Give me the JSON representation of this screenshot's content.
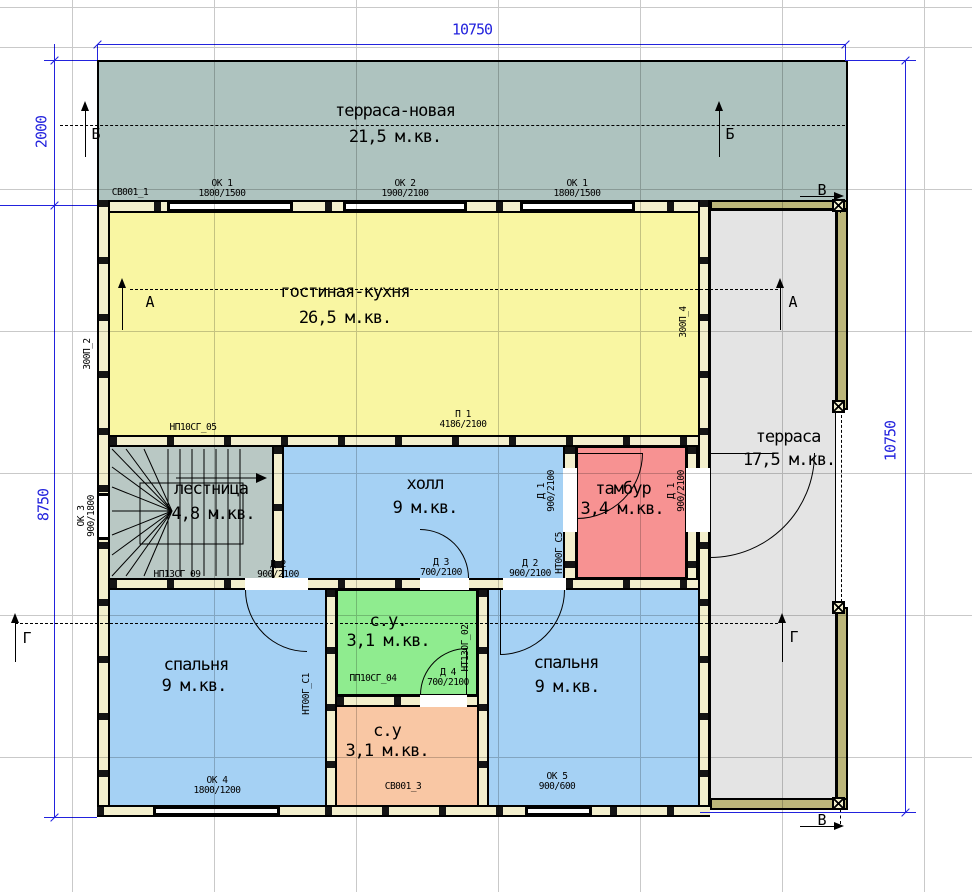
{
  "rooms": {
    "terrace_new": {
      "name": "терраса-новая",
      "area": "21,5 м.кв."
    },
    "living": {
      "name": "гостиная-кухня",
      "area": "26,5 м.кв."
    },
    "stairs": {
      "name": "лестница",
      "area": "4,8 м.кв."
    },
    "hall": {
      "name": "холл",
      "area": "9 м.кв."
    },
    "tambour": {
      "name": "тамбур",
      "area": "3,4 м.кв."
    },
    "terrace": {
      "name": "терраса",
      "area": "17,5 м.кв."
    },
    "bedroom_left": {
      "name": "спальня",
      "area": "9 м.кв."
    },
    "wc_top": {
      "name": "с.у.",
      "area": "3,1 м.кв."
    },
    "wc_bottom": {
      "name": "с.у",
      "area": "3,1 м.кв."
    },
    "bedroom_right": {
      "name": "спальня",
      "area": "9 м.кв."
    }
  },
  "dimensions": {
    "top": "10750",
    "left_upper": "2000",
    "left_lower": "8750",
    "right": "10750"
  },
  "sections": {
    "a": "А",
    "b": "Б",
    "v": "В",
    "g": "Г"
  },
  "openings": {
    "sv001_1": "СВ001_1",
    "ok1_top_left": "ОК 1\n1800/1500",
    "ok2_top": "ОК 2\n1900/2100",
    "ok1_top_right": "ОК 1\n1800/1500",
    "ok3_left": "ОК 3\n900/1800",
    "ok4_bottom": "ОК 4\n1800/1200",
    "ok5_bottom": "ОК 5\n900/600",
    "sv001_3": "СВ001_3",
    "p1": "П 1\n4186/2100",
    "d1_left": "Д 1\n900/2100",
    "d1_right": "Д 1\n900/2100",
    "d2_stairs": "Д 2\n900/2100",
    "d2_hall": "Д 2\n900/2100",
    "d3_hall": "Д 3\n700/2100",
    "d4_wc": "Д 4\n700/2100"
  },
  "panels": {
    "np10sg_05": "НП10СГ_05",
    "np13sg_09": "НП13СГ_09",
    "pp10sg_04": "ПП10СГ_04",
    "nt00g_s1": "НТ00Г_С1",
    "nt13og_02": "НТ13ОГ_02",
    "nt00g_s5": "НТ00Г_С5",
    "z00p_2": "З00П_2",
    "z00p_4": "З00П_4"
  },
  "colors": {
    "terrace_new": "#aec3bf",
    "living": "#f9f6a2",
    "stairs": "#b9c8c4",
    "hall": "#a5d1f4",
    "tambour": "#f79292",
    "terrace": "#e4e4e4",
    "bedroom": "#a5d1f4",
    "wc_top": "#8fec8f",
    "wc_bottom": "#f9c7a4",
    "wall": "#f3efcd",
    "khaki": "#bcb67a",
    "dim": "#2222dd",
    "grid": "#c9c9c9"
  }
}
